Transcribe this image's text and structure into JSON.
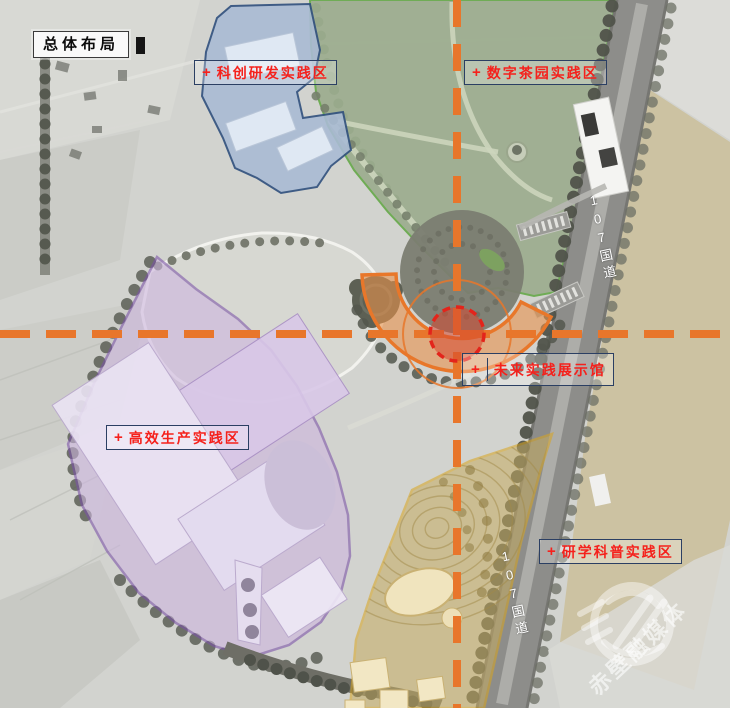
{
  "title": "总体布局",
  "zones": [
    {
      "plus": "+",
      "name": "科创研发实践区",
      "fill": "#A9BBD4",
      "border": "#30507E"
    },
    {
      "plus": "+",
      "name": "数字茶园实践区",
      "fill": "#9CAD8E",
      "border": "#67A94B"
    },
    {
      "plus": "+",
      "name": "未来实践展示馆",
      "fill": "#E8772A",
      "border": "#E8772A"
    },
    {
      "plus": "+",
      "name": "高效生产实践区",
      "fill": "#CDB5E0",
      "border": "#7B52A8"
    },
    {
      "plus": "+",
      "name": "研学科普实践区",
      "fill": "#C6AC62",
      "border": "#D9A520"
    }
  ],
  "roads": {
    "national_road_label": "107国道"
  },
  "watermark": {
    "text": "赤壁融媒体"
  },
  "annotation_colors": {
    "label_text": "#F5211C",
    "label_border": "#2B3F63",
    "axis_dashed_line": "#E8762B",
    "core_marker": "#E3241B"
  }
}
